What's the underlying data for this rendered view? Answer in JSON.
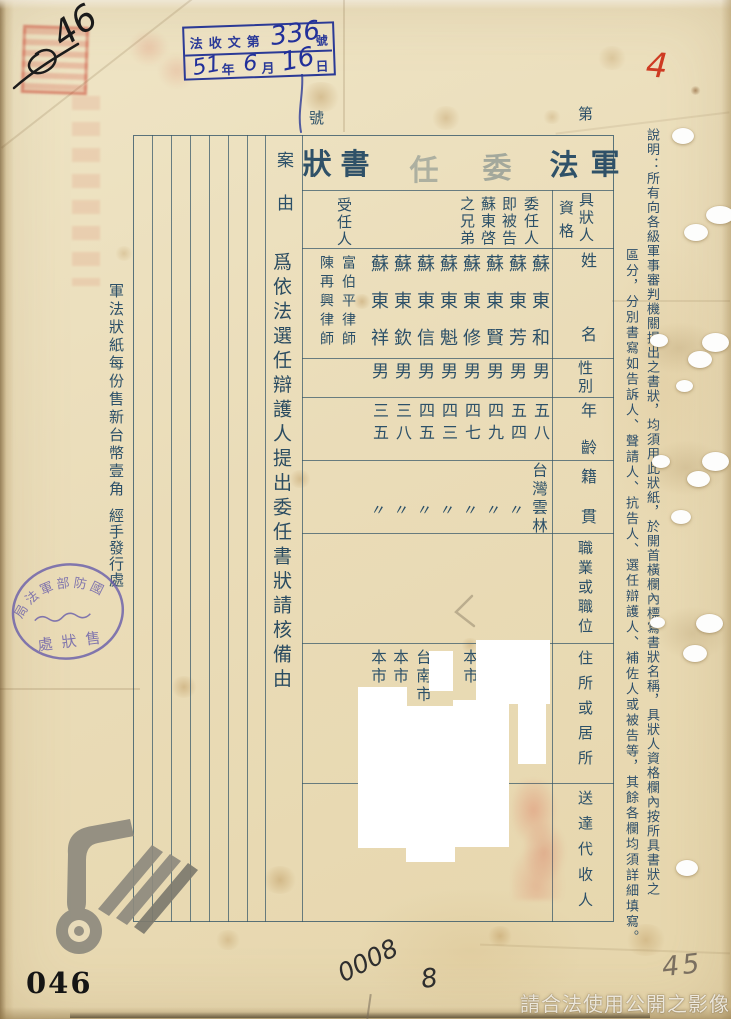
{
  "annotations": {
    "top_left_number": "46",
    "top_right_number": "4",
    "bottom_left_number": "046",
    "bottom_center_number": "0008",
    "bottom_center_number2": "8",
    "bottom_right_number": "45",
    "watermark_text": "請合法使用公開之影像"
  },
  "receipt_stamp": {
    "prefix": "法收文第",
    "number": "336",
    "suffix": "號",
    "year": "51",
    "year_label": "年",
    "month": "6",
    "month_label": "月",
    "day": "16",
    "day_label": "日"
  },
  "left_margin": {
    "price_note": "軍法狀紙每份售新台幣壹角",
    "handler_note": "經手發行處",
    "oval_stamp_arc": "國防部軍法局",
    "oval_stamp_bottom": "售狀處"
  },
  "form": {
    "number_prefix": "第",
    "number_suffix": "號",
    "title": {
      "chars": [
        "軍",
        "法",
        "委",
        "任",
        "書",
        "狀"
      ]
    },
    "case": {
      "label": "案由",
      "text": "爲依法選任辯護人提出委任書狀請核備由"
    },
    "field_headers": {
      "qualification": "具狀人",
      "qualification2": "資格",
      "name": "姓名",
      "sex": "性別",
      "age": "年齡",
      "origin": "籍貫",
      "occupation": "職業或職位",
      "residence": "住所或居所",
      "agent": "送達代收人"
    },
    "appointor_role": [
      "委任人",
      "即被告",
      "蘇東啓",
      "之兄弟"
    ],
    "appointee_role": "受任人",
    "persons": [
      {
        "name": "蘇東和",
        "sex": "男",
        "age": "五八",
        "origin": "台灣雲林",
        "residence": ""
      },
      {
        "name": "蘇東芳",
        "sex": "男",
        "age": "五四",
        "origin": "〃",
        "residence": ""
      },
      {
        "name": "蘇東賢",
        "sex": "男",
        "age": "四九",
        "origin": "〃",
        "residence": ""
      },
      {
        "name": "蘇東修",
        "sex": "男",
        "age": "四七",
        "origin": "〃",
        "residence": "本市"
      },
      {
        "name": "蘇東魁",
        "sex": "男",
        "age": "四三",
        "origin": "〃",
        "residence": ""
      },
      {
        "name": "蘇東信",
        "sex": "男",
        "age": "四五",
        "origin": "〃",
        "residence": "台南市"
      },
      {
        "name": "蘇東欽",
        "sex": "男",
        "age": "三八",
        "origin": "〃",
        "residence": "本市"
      },
      {
        "name": "蘇東祥",
        "sex": "男",
        "age": "三五",
        "origin": "〃",
        "residence": "本市"
      }
    ],
    "appointees": [
      "富伯平律師",
      "陳再興律師"
    ]
  },
  "instructions": {
    "column1": "說明：所有向各級軍事審判機關提出之書狀，均須用此狀紙，於開首橫欄內標寫書狀名稱，具狀人資格欄內按所具書狀之",
    "column2": "區分，分別書寫如告訴人、聲請人、抗告人、選任辯護人、補佐人或被告等，其餘各欄均須詳細填寫。"
  }
}
